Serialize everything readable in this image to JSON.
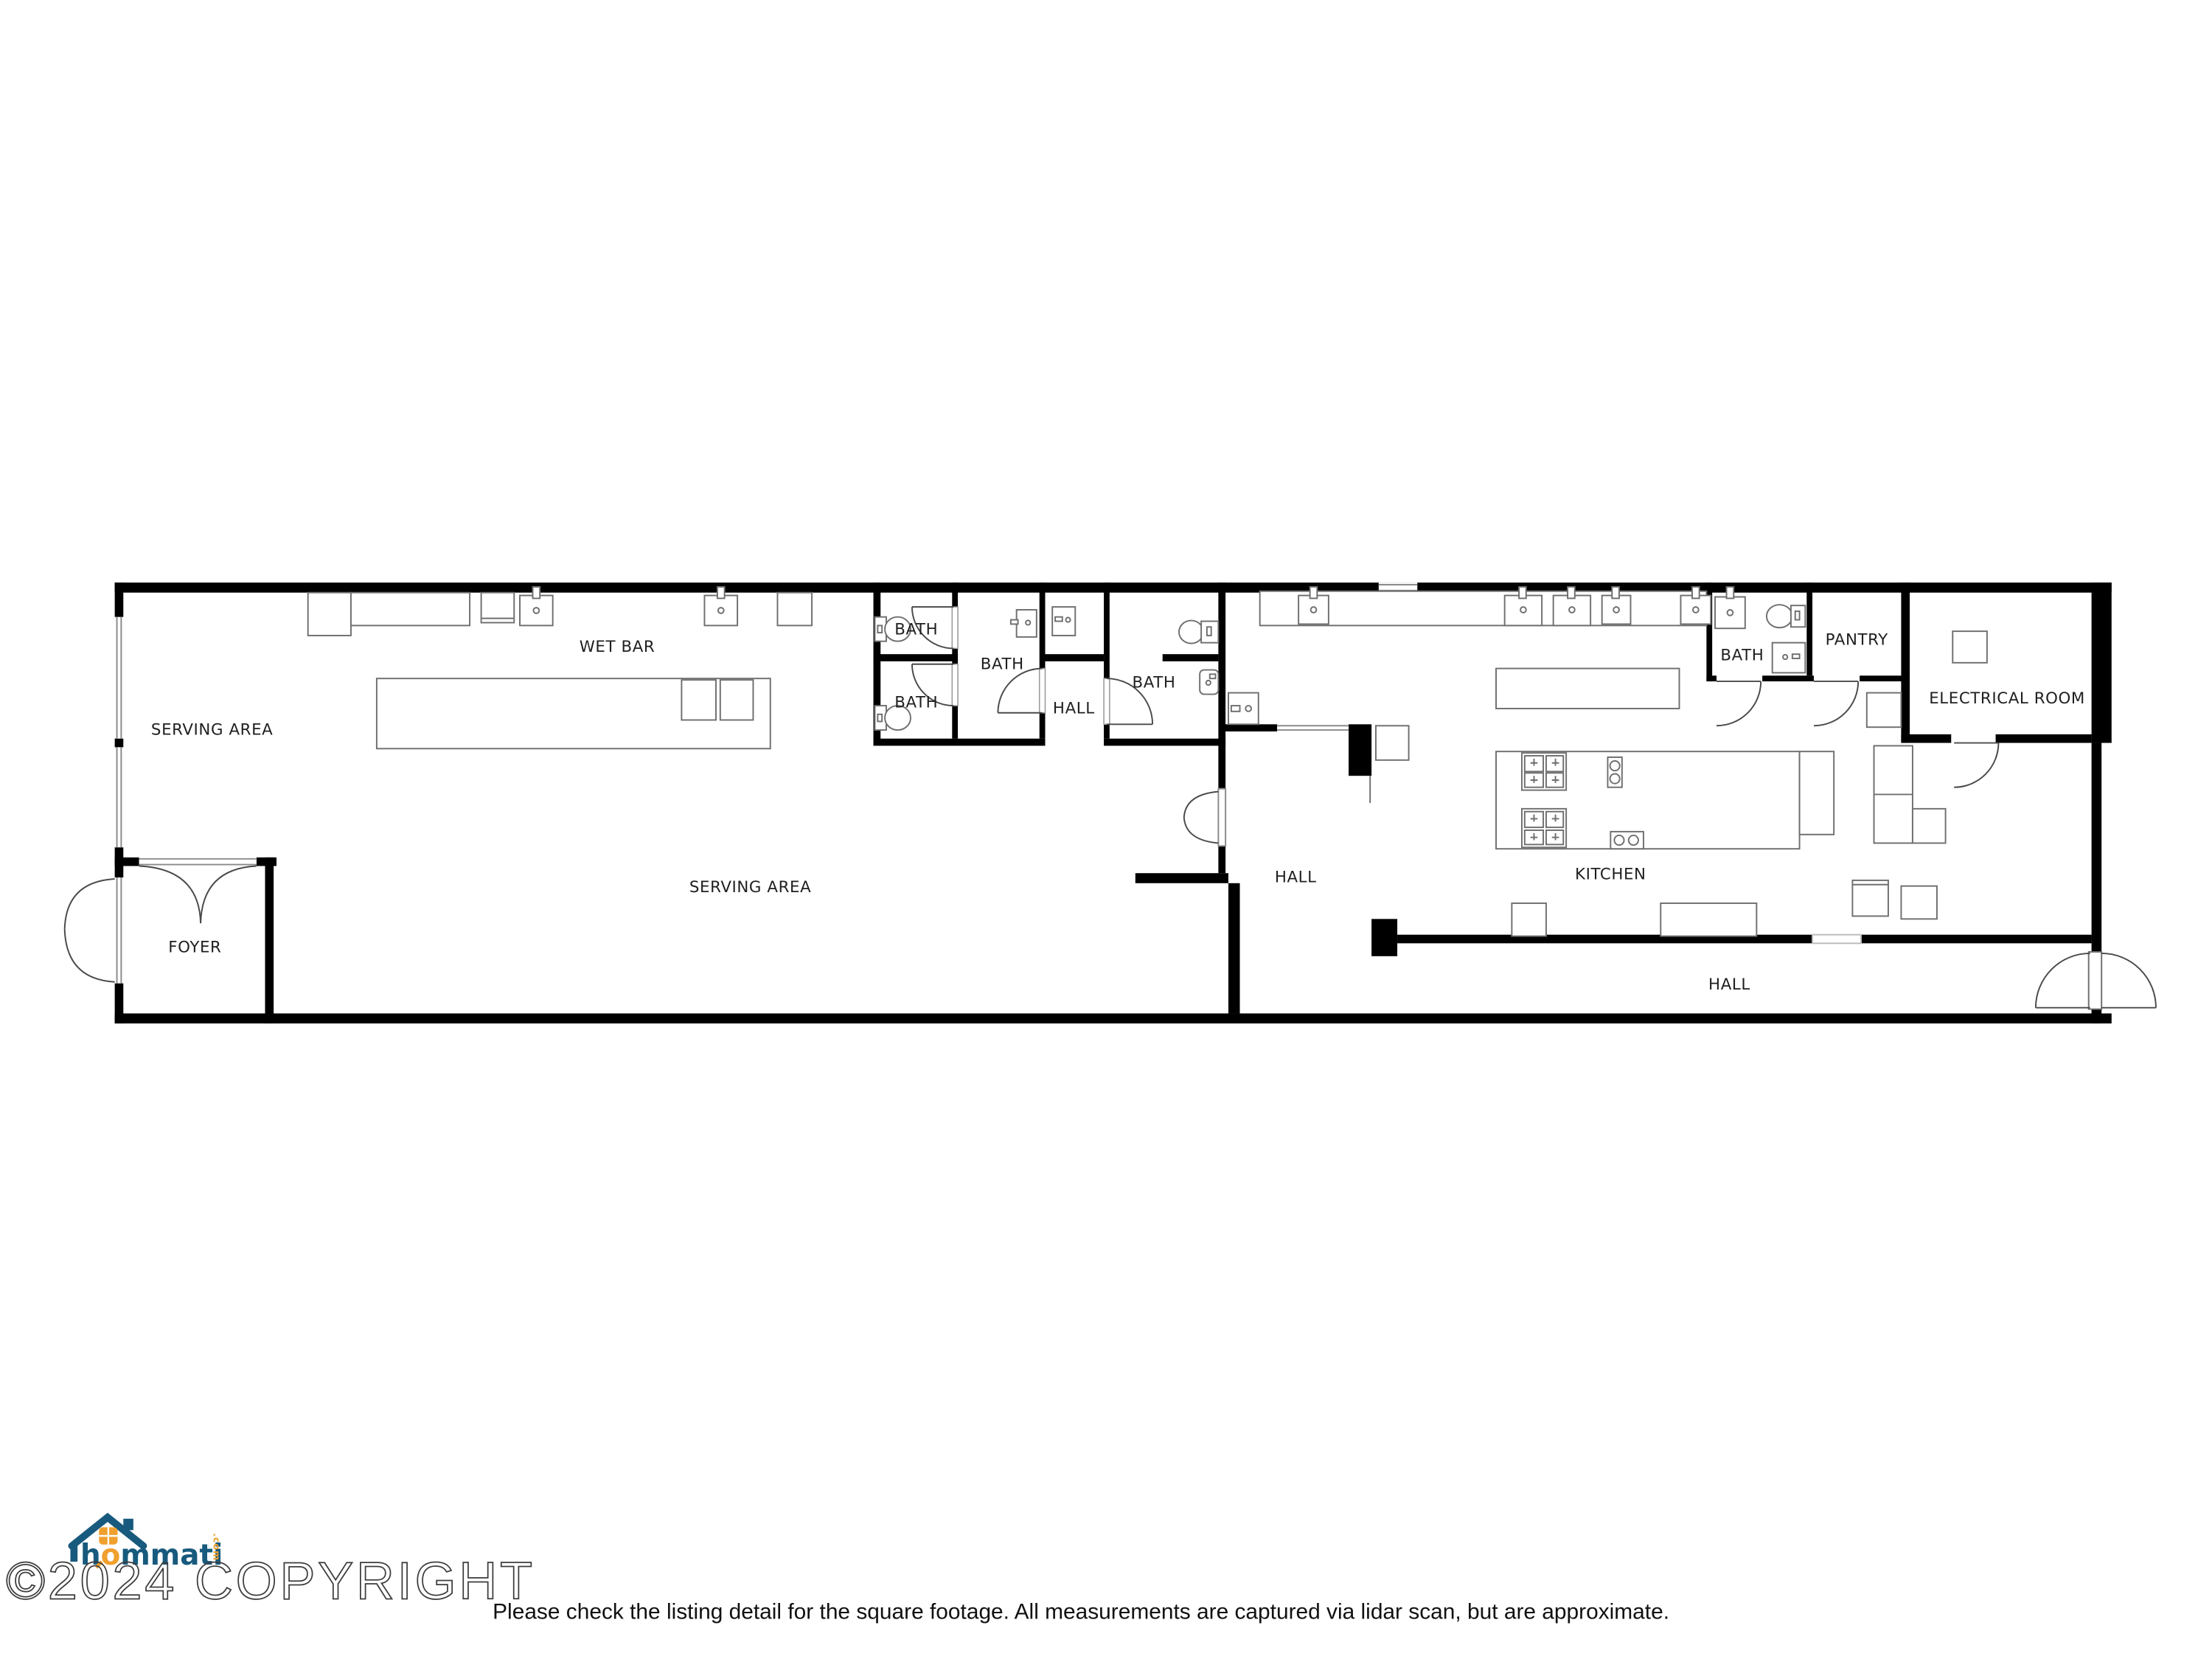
{
  "rooms": [
    {
      "id": "wet-bar",
      "label": "WET BAR"
    },
    {
      "id": "serving-area-west",
      "label": "SERVING AREA"
    },
    {
      "id": "serving-area-main",
      "label": "SERVING AREA"
    },
    {
      "id": "foyer",
      "label": "FOYER"
    },
    {
      "id": "bath-small-top",
      "label": "BATH"
    },
    {
      "id": "bath-small-bottom",
      "label": "BATH"
    },
    {
      "id": "bath-middle",
      "label": "BATH"
    },
    {
      "id": "hall-baths",
      "label": "HALL"
    },
    {
      "id": "bath-right",
      "label": "BATH"
    },
    {
      "id": "hall-center",
      "label": "HALL"
    },
    {
      "id": "kitchen",
      "label": "KITCHEN"
    },
    {
      "id": "bath-east",
      "label": "BATH"
    },
    {
      "id": "pantry",
      "label": "PANTRY"
    },
    {
      "id": "electrical-room",
      "label": "ELECTRICAL ROOM"
    },
    {
      "id": "hall-rear",
      "label": "HALL"
    }
  ],
  "branding": {
    "logo_text_lead": "h",
    "logo_text_o": "o",
    "logo_text_rest": "mmati",
    "logo_tld": ".com",
    "copyright": "©2024 COPYRIGHT"
  },
  "footer": {
    "disclaimer": "Please check the listing detail for the square footage. All measurements are captured via lidar scan, but are approximate."
  },
  "colors": {
    "wall": "#000000",
    "fixture": "#6f6f6f",
    "logo_blue": "#185a7d",
    "logo_orange": "#f0a02e"
  }
}
